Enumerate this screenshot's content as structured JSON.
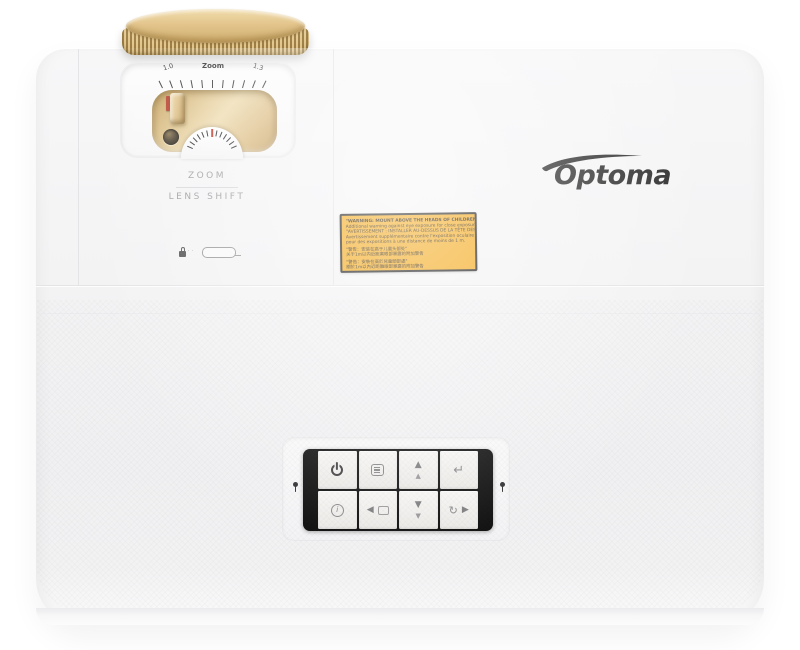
{
  "logo": {
    "text": "Optoma",
    "color": "#2c2c2c"
  },
  "lens_controls": {
    "scale": {
      "min": "1.0",
      "label": "Zoom",
      "max": "1.3",
      "tick_count": 11
    },
    "dial": {
      "tick_count": 13,
      "pointer_color": "#c23b2e"
    },
    "zoom_label": "ZOOM",
    "lens_shift_label": "LENS SHIFT"
  },
  "security_mark": {
    "icon": "kensington-lock-icon",
    "dots": "· ·"
  },
  "warning_label": {
    "bg_color": "#f3a818",
    "border_color": "#191919",
    "lines": [
      "\"WARNING: MOUNT ABOVE THE HEADS OF CHILDREN.\"",
      "Additional warning against eye exposure for close exposures less than 1 m.",
      "\"AVERTISSEMENT : INSTALLER AU-DESSUS DE LA TÊTE DES ENFANTS.\"",
      "Avertissement supplémentaire contre l'exposition oculaire pour des expositions à une distance de moins de 1 m.",
      "\"警告：安装在高于儿童头部处\"",
      "关于1m以内近距离眼部暴露的附加警告",
      "\"警告：安裝在高於兒童頭部處\"",
      "關於1m以內近距離眼部暴露的附加警告"
    ]
  },
  "control_panel": {
    "buttons": [
      {
        "id": "power",
        "icon": "power-icon"
      },
      {
        "id": "menu",
        "icon": "menu-icon"
      },
      {
        "id": "up",
        "icon": "up-arrows-icon",
        "glyph_primary": "▲",
        "glyph_secondary": "▲"
      },
      {
        "id": "enter",
        "icon": "enter-icon",
        "glyph": "↵"
      },
      {
        "id": "info",
        "icon": "info-icon",
        "glyph": "i"
      },
      {
        "id": "left",
        "icon": "left-arrow-icon",
        "glyph": "◀"
      },
      {
        "id": "down",
        "icon": "down-arrows-icon",
        "glyph_primary": "▼",
        "glyph_secondary": "▼"
      },
      {
        "id": "resync_right",
        "icon": "resync-right-icon",
        "glyph_resync": "↻",
        "glyph_arrow": "▶"
      }
    ]
  },
  "indicators": {
    "left": "lamp-indicator",
    "right": "temp-indicator"
  },
  "colors": {
    "gold": "#d7b77f",
    "body": "#f2f2f3",
    "panel_black": "#0c0c0c",
    "label_yellow": "#f3a818",
    "pointer_red": "#c23b2e",
    "logo": "#2c2c2c"
  }
}
